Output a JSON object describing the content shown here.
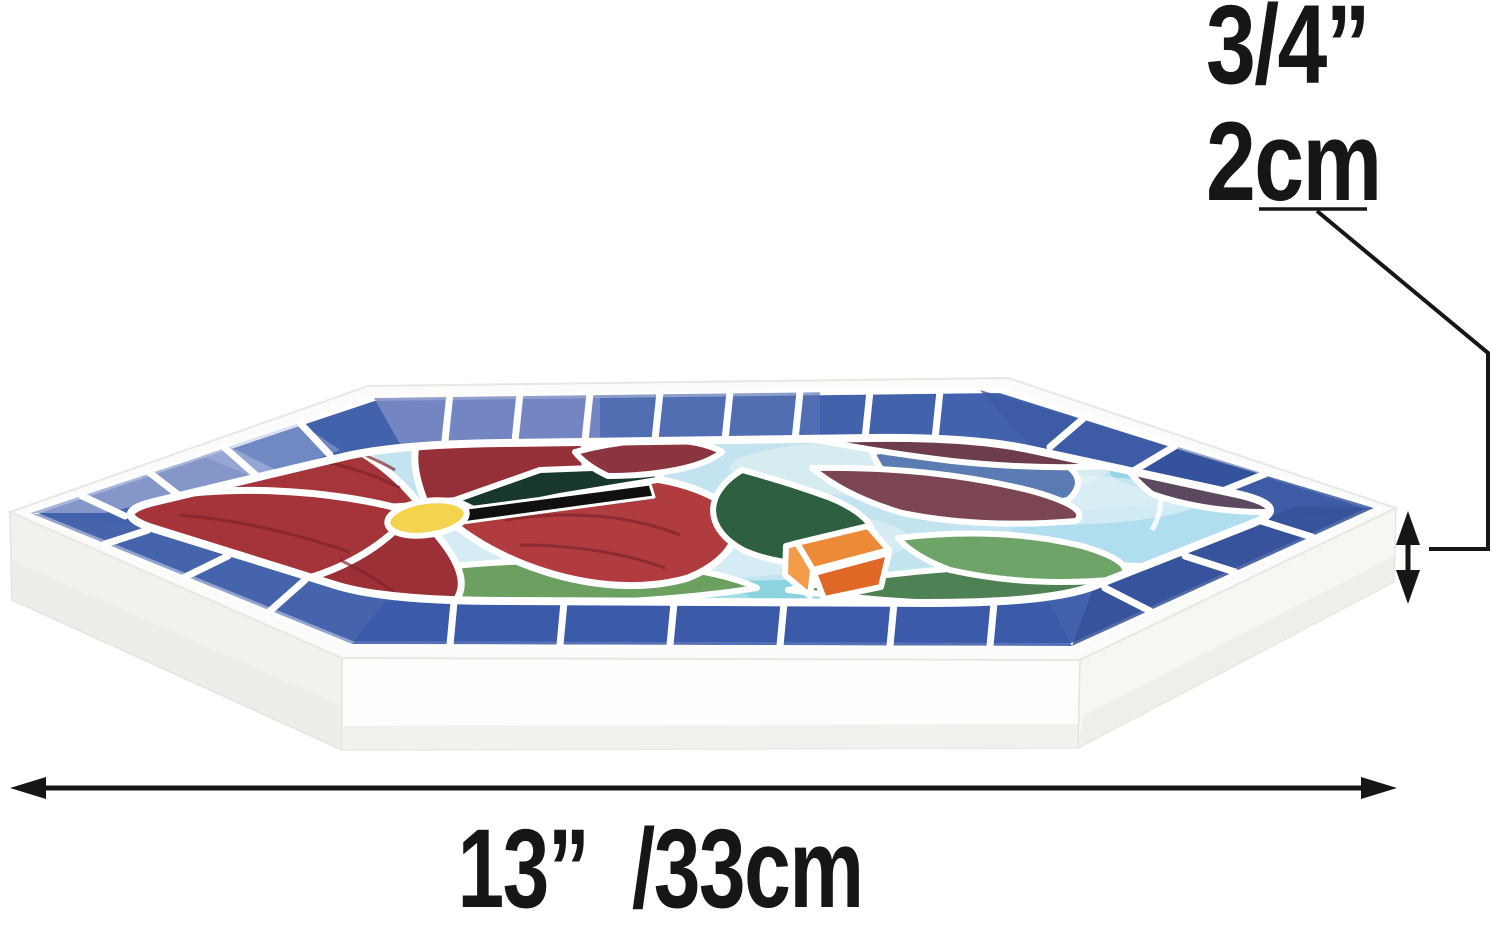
{
  "annotations": {
    "thickness": {
      "inches": "3/4”",
      "cm": "2cm"
    },
    "width": {
      "inches": "13”",
      "cm": "/33cm"
    }
  },
  "subject": {
    "name": "hexagonal-mosaic-stepping-stone",
    "motif": "stained glass mosaic: red flower, hummingbird, blue tile border"
  },
  "palette": {
    "annotation_black": "#161616",
    "stone_white": "#fbfbf9",
    "grout_white": "#ffffff",
    "border_blue": "#4263ab",
    "field_light_blue": "#c3e3f0",
    "flower_red": "#a5343b",
    "flower_center_yellow": "#f2d44f",
    "leaf_green": "#6ba061",
    "wing_maroon": "#6e3d4b",
    "tail_orange": "#ec8a38",
    "bird_back_blue": "#5a7cb2"
  },
  "icons": {
    "width_dimension": "horizontal-double-arrow-icon",
    "thickness_dimension": "vertical-double-arrow-icon"
  }
}
